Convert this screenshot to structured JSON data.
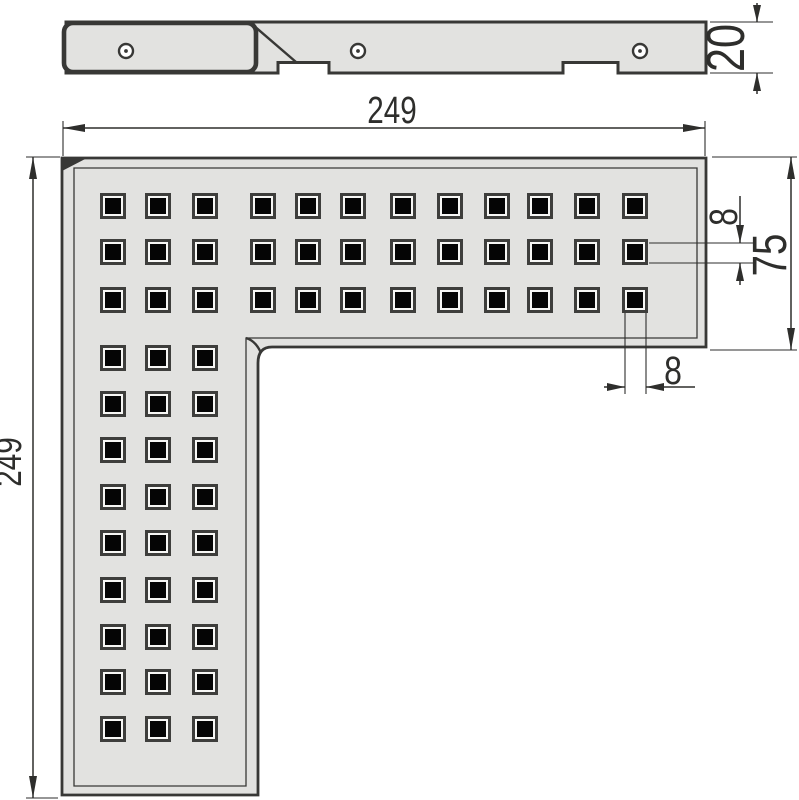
{
  "drawing": {
    "dimensions": {
      "top_width": "249",
      "left_height": "249",
      "profile_height": "20",
      "arm_width": "75",
      "hole_height": "8",
      "hole_width": "8"
    },
    "plan_view": {
      "hole_grid": {
        "col_centers": [
          113,
          158,
          205,
          263,
          308,
          353,
          403,
          450,
          497,
          540,
          587,
          635
        ],
        "row_centers": [
          206,
          252,
          300,
          358,
          404,
          450,
          497,
          543,
          590,
          637,
          682,
          729
        ],
        "full_rows": 3,
        "full_cols": 3,
        "hole_outer": 26,
        "hole_ring": 20,
        "hole_inner": 16
      }
    },
    "side_view": {
      "rivet_centers": [
        [
          126,
          51
        ],
        [
          358,
          51
        ],
        [
          640,
          51
        ]
      ],
      "rivet_radius": 7,
      "rivet_dot_radius": 1.9
    },
    "colors": {
      "background": "#ffffff",
      "plate": "#e2e2e0",
      "line": "#383836",
      "dim": "#2e2e2c",
      "hole_frame": "#3e3e3c",
      "hole_ring": "#f7f7f5",
      "hole": "#050505"
    }
  }
}
